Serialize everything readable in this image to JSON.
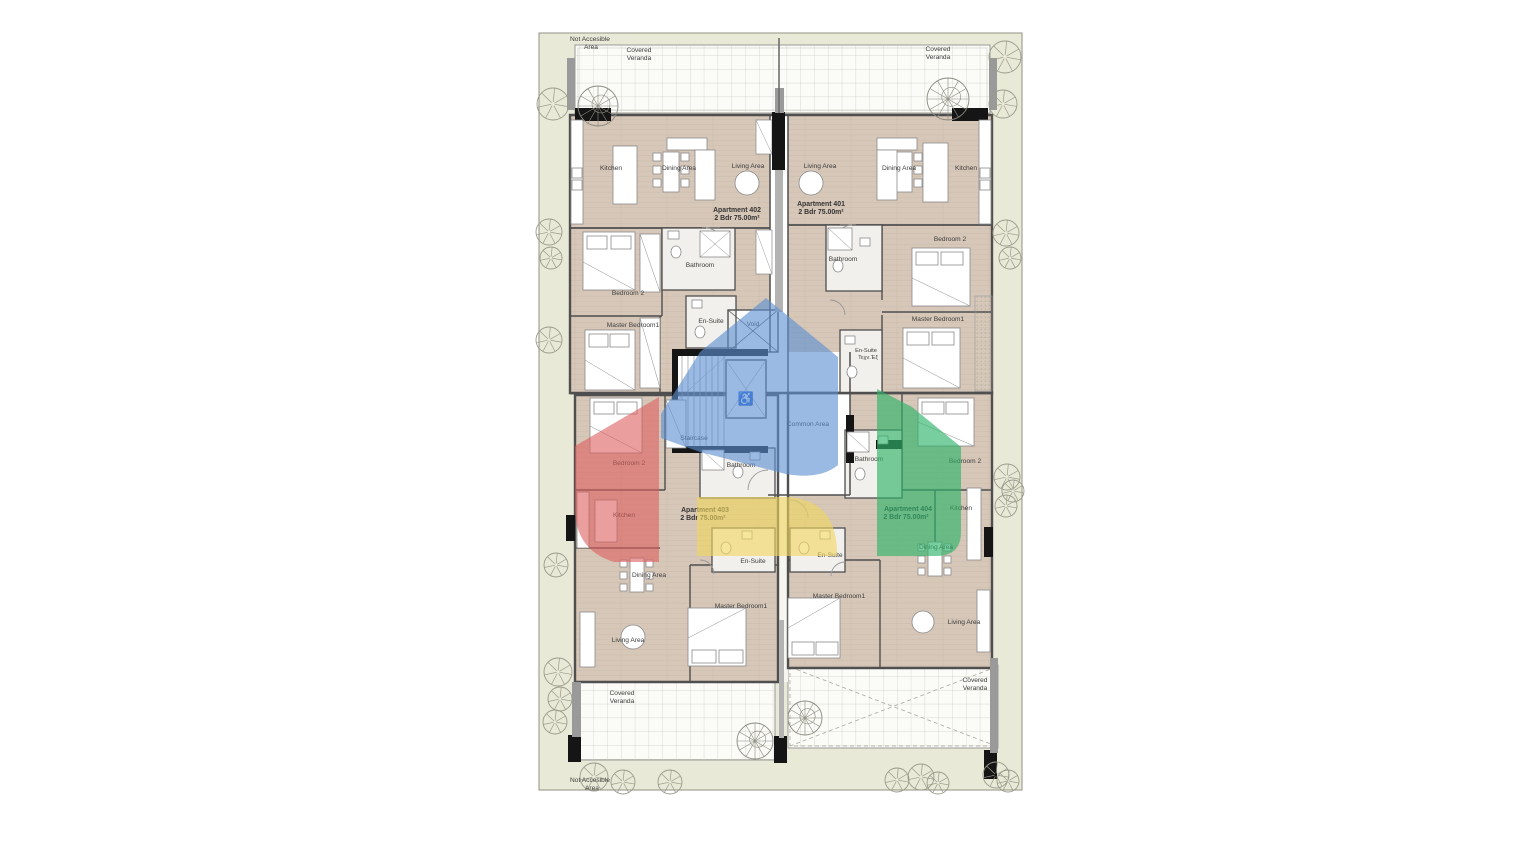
{
  "page": {
    "background": "#ffffff"
  },
  "colors": {
    "site_fill": "#e8e9d7",
    "site_border": "#9a9a8c",
    "floor": "#d6c7b8",
    "wall": "#4f4f4f",
    "wall_black": "#151515",
    "veranda_fill": "#fbfbf8",
    "veranda_grid": "#cdcdc4",
    "tree_stroke": "#9b9b8b"
  },
  "overlays": [
    {
      "name": "highlight-red",
      "color": "#dd5e5e"
    },
    {
      "name": "highlight-blue",
      "color": "#5c8fd2"
    },
    {
      "name": "highlight-yellow",
      "color": "#f0d65f"
    },
    {
      "name": "highlight-green",
      "color": "#2fb46a"
    }
  ],
  "plan": {
    "icons": {
      "accessibility": "♿"
    },
    "labels": [
      {
        "t": "Not Accesible",
        "x": 590,
        "y": 41,
        "n": "not-accessible-area-top-label"
      },
      {
        "t": "Area",
        "x": 591,
        "y": 49,
        "n": "not-accessible-area-top-label-line2"
      },
      {
        "t": "Covered",
        "x": 639,
        "y": 52,
        "n": "covered-veranda-top-left-label"
      },
      {
        "t": "Veranda",
        "x": 639,
        "y": 60,
        "n": "covered-veranda-top-left-label-line2"
      },
      {
        "t": "Covered",
        "x": 938,
        "y": 51,
        "n": "covered-veranda-top-right-label"
      },
      {
        "t": "Veranda",
        "x": 938,
        "y": 59,
        "n": "covered-veranda-top-right-label-line2"
      },
      {
        "t": "Kitchen",
        "x": 611,
        "y": 170,
        "n": "apt402-kitchen-label"
      },
      {
        "t": "Dining Area",
        "x": 679,
        "y": 170,
        "n": "apt402-dining-label"
      },
      {
        "t": "Living Area",
        "x": 748,
        "y": 168,
        "n": "apt402-living-label"
      },
      {
        "t": "Living Area",
        "x": 820,
        "y": 168,
        "n": "apt401-living-label"
      },
      {
        "t": "Dining Area",
        "x": 899,
        "y": 170,
        "n": "apt401-dining-label"
      },
      {
        "t": "Kitchen",
        "x": 966,
        "y": 170,
        "n": "apt401-kitchen-label"
      },
      {
        "t": "Apartment 402",
        "x": 737,
        "y": 212,
        "b": 1,
        "n": "apartment-402-label"
      },
      {
        "t": "2 Bdr 75.00m²",
        "x": 737,
        "y": 220,
        "b": 1,
        "n": "apartment-402-spec"
      },
      {
        "t": "Apartment 401",
        "x": 821,
        "y": 206,
        "b": 1,
        "n": "apartment-401-label"
      },
      {
        "t": "2 Bdr 75.00m²",
        "x": 821,
        "y": 214,
        "b": 1,
        "n": "apartment-401-spec"
      },
      {
        "t": "Bathroom",
        "x": 700,
        "y": 267,
        "n": "apt402-bathroom-label"
      },
      {
        "t": "Bathroom",
        "x": 843,
        "y": 261,
        "n": "apt401-bathroom-label"
      },
      {
        "t": "Bedroom 2",
        "x": 628,
        "y": 295,
        "n": "apt402-bedroom2-label"
      },
      {
        "t": "Bedroom 2",
        "x": 950,
        "y": 241,
        "n": "apt401-bedroom2-label"
      },
      {
        "t": "Master Bedroom1",
        "x": 633,
        "y": 327,
        "n": "apt402-master-label"
      },
      {
        "t": "En-Suite",
        "x": 711,
        "y": 323,
        "n": "apt402-ensuite-label"
      },
      {
        "t": "Void",
        "x": 753,
        "y": 326,
        "n": "void-label"
      },
      {
        "t": "Master Bedroom1",
        "x": 938,
        "y": 321,
        "n": "apt401-master-label"
      },
      {
        "t": "En-Suite",
        "x": 866,
        "y": 352,
        "s": 1,
        "n": "apt401-ensuite-label"
      },
      {
        "t": "Τεχν.Έξ",
        "x": 868,
        "y": 359,
        "s": 1,
        "n": "apt401-ensuite-label-line2"
      },
      {
        "t": "Staircase",
        "x": 694,
        "y": 440,
        "n": "staircase-label"
      },
      {
        "t": "Common Area",
        "x": 808,
        "y": 426,
        "n": "common-area-label"
      },
      {
        "t": "Bedroom 2",
        "x": 629,
        "y": 465,
        "n": "apt403-bedroom2-label"
      },
      {
        "t": "Bathroom",
        "x": 741,
        "y": 467,
        "n": "apt403-bathroom-label"
      },
      {
        "t": "Bathroom",
        "x": 869,
        "y": 461,
        "n": "apt404-bathroom-label"
      },
      {
        "t": "Bedroom 2",
        "x": 965,
        "y": 463,
        "n": "apt404-bedroom2-label"
      },
      {
        "t": "Kitchen",
        "x": 624,
        "y": 517,
        "n": "apt403-kitchen-label"
      },
      {
        "t": "Apartment 403",
        "x": 705,
        "y": 512,
        "b": 1,
        "n": "apartment-403-label"
      },
      {
        "t": "2 Bdr 75.00m²",
        "x": 703,
        "y": 520,
        "b": 1,
        "n": "apartment-403-spec"
      },
      {
        "t": "Apartment 404",
        "x": 908,
        "y": 511,
        "b": 1,
        "n": "apartment-404-label"
      },
      {
        "t": "2 Bdr 75.00m²",
        "x": 906,
        "y": 519,
        "b": 1,
        "n": "apartment-404-spec"
      },
      {
        "t": "Kitchen",
        "x": 961,
        "y": 510,
        "n": "apt404-kitchen-label"
      },
      {
        "t": "En-Suite",
        "x": 753,
        "y": 563,
        "n": "apt403-ensuite-label"
      },
      {
        "t": "En-Suite",
        "x": 830,
        "y": 557,
        "n": "apt404-ensuite-label"
      },
      {
        "t": "Dining Area",
        "x": 649,
        "y": 577,
        "n": "apt403-dining-label"
      },
      {
        "t": "Dining Area",
        "x": 936,
        "y": 549,
        "n": "apt404-dining-label"
      },
      {
        "t": "Master Bedroom1",
        "x": 741,
        "y": 608,
        "n": "apt403-master-label"
      },
      {
        "t": "Master Bedroom1",
        "x": 839,
        "y": 598,
        "n": "apt404-master-label"
      },
      {
        "t": "Living Area",
        "x": 628,
        "y": 642,
        "n": "apt403-living-label"
      },
      {
        "t": "Living Area",
        "x": 964,
        "y": 624,
        "n": "apt404-living-label"
      },
      {
        "t": "Covered",
        "x": 622,
        "y": 695,
        "n": "covered-veranda-bottom-left-label"
      },
      {
        "t": "Veranda",
        "x": 622,
        "y": 703,
        "n": "covered-veranda-bottom-left-label-line2"
      },
      {
        "t": "Covered",
        "x": 975,
        "y": 682,
        "n": "covered-veranda-bottom-right-label"
      },
      {
        "t": "Veranda",
        "x": 975,
        "y": 690,
        "n": "covered-veranda-bottom-right-label-line2"
      },
      {
        "t": "Not Accesible",
        "x": 590,
        "y": 782,
        "n": "not-accessible-area-bottom-label"
      },
      {
        "t": "Area",
        "x": 592,
        "y": 790,
        "n": "not-accessible-area-bottom-label-line2"
      }
    ],
    "trees": [
      [
        553,
        104,
        16
      ],
      [
        549,
        232,
        13
      ],
      [
        551,
        258,
        11
      ],
      [
        549,
        340,
        13
      ],
      [
        556,
        565,
        12
      ],
      [
        558,
        672,
        14
      ],
      [
        560,
        699,
        12
      ],
      [
        555,
        722,
        12
      ],
      [
        1005,
        57,
        16
      ],
      [
        1003,
        104,
        14
      ],
      [
        1006,
        233,
        13
      ],
      [
        1010,
        258,
        11
      ],
      [
        1007,
        477,
        13
      ],
      [
        1013,
        491,
        11
      ],
      [
        1006,
        506,
        11
      ],
      [
        594,
        777,
        14
      ],
      [
        623,
        782,
        12
      ],
      [
        670,
        782,
        12
      ],
      [
        897,
        780,
        12
      ],
      [
        921,
        777,
        13
      ],
      [
        938,
        783,
        11
      ],
      [
        996,
        775,
        13
      ],
      [
        1008,
        781,
        11
      ]
    ],
    "spiral_stairs": [
      [
        598,
        106,
        20
      ],
      [
        948,
        99,
        21
      ],
      [
        755,
        741,
        18
      ],
      [
        805,
        718,
        17
      ]
    ]
  }
}
